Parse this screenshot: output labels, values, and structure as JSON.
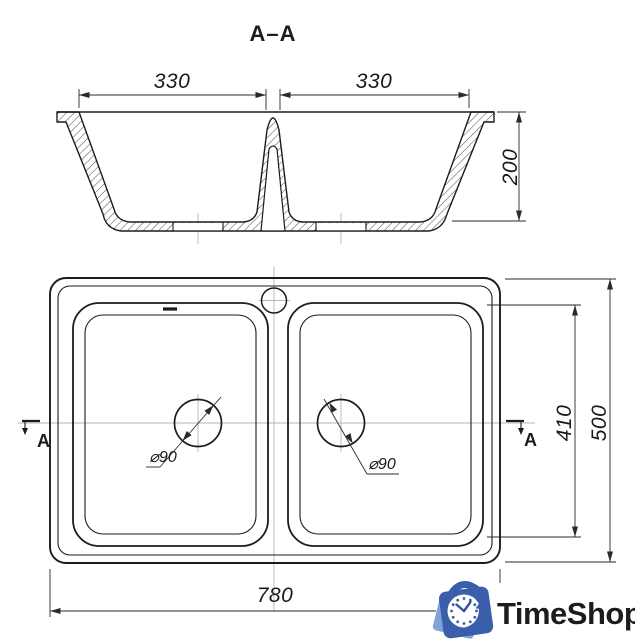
{
  "title": "A–A",
  "section_view": {
    "label_left_bowl_width": "330",
    "label_right_bowl_width": "330",
    "label_depth": "200"
  },
  "plan_view": {
    "label_bowl_length": "410",
    "label_overall_width": "500",
    "label_overall_length": "780",
    "label_drain_left": "⌀90",
    "label_drain_right": "⌀90",
    "marker_left": "A",
    "marker_right": "A"
  },
  "logo": {
    "text": "TimeShop",
    "icon": "clock-shopping-bag-icon",
    "text_color": "#4b80cd",
    "icon_dark_blue": "#3a5ea9",
    "icon_light_blue": "#7fa3d8"
  },
  "colors": {
    "background": "#ffffff",
    "drawing_line": "#1c1c1c",
    "dimension_line": "#2a2a2a",
    "centerline": "#b5b5b5",
    "hatch": "#4a4a4a"
  }
}
